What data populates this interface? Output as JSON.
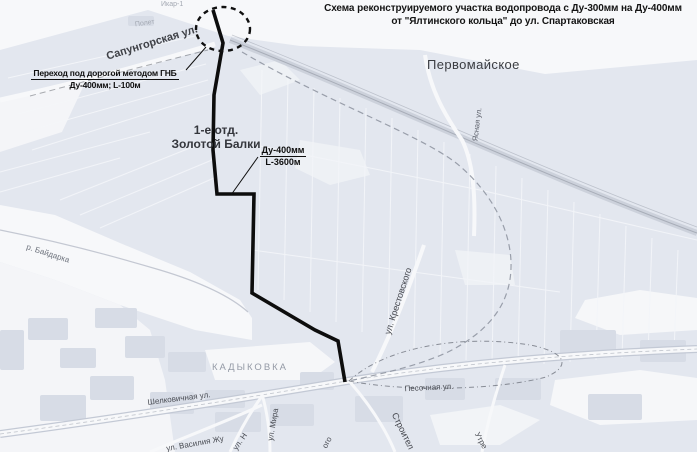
{
  "title": {
    "line1": "Схема реконструируемого участка водопровода с Ду-300мм на Ду-400мм",
    "line2": "от \"Ялтинского кольца\"  до ул. Спартаковская"
  },
  "annotations": {
    "hdd": {
      "line1": "Переход под дорогой методом ГНБ",
      "line2": "Ду-400мм; L-100м"
    },
    "pipe": {
      "line1": "Ду-400мм",
      "line2": "L-3600м"
    }
  },
  "map_labels": {
    "settlement_pervomayskoe": "Первомайское",
    "settlement_zb_line1": "1-е отд.",
    "settlement_zb_line2": "Золотой Балки",
    "district_kadykovka": "КАДЫКОВКА",
    "street_sapungorskaya": "Сапунгорская ул.",
    "street_yasnaya": "Ясная ул.",
    "street_krestovskogo": "ул. Крестовского",
    "street_shelkovichnaya": "Шелковичная ул.",
    "street_pesochnaya": "Песочная ул.",
    "street_mira": "ул. Мира",
    "street_n": "ул. Н",
    "street_vasiliya_zhukova": "ул. Василия Жу",
    "street_ogo": "ого",
    "street_stroiteley": "Строител",
    "street_utrennyaya": "Утре",
    "river_baydarka": "р. Байдарка",
    "poi_ikar": "Икар-1",
    "poi_polet": "Полет"
  },
  "colors": {
    "pipeline": "#0d0d0d",
    "annotation_text": "#0f0f0f",
    "field_fill": "#e3e7ef",
    "map_label_text": "#3f4147"
  }
}
